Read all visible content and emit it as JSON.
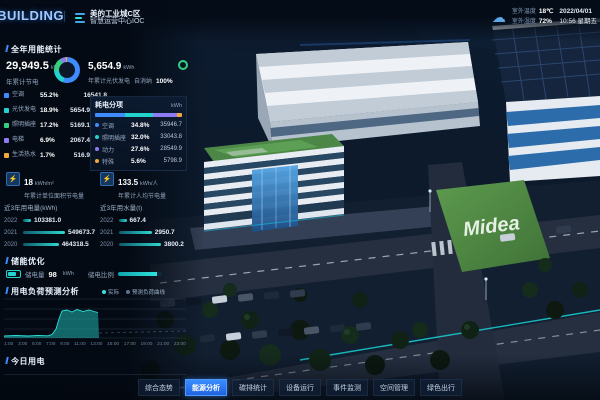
{
  "header": {
    "logo": "iBUILDING",
    "divider": "|",
    "brand_line1": "美的工业城C区",
    "brand_line2": "智慧运营中心IOC",
    "weather": {
      "cloud_icon": "☁",
      "temp_label": "室外温度",
      "temp_value": "18℃",
      "humidity_label": "室外湿度",
      "humidity_value": "72%",
      "date": "2022/04/01",
      "time": "10:56 星期五"
    }
  },
  "energy": {
    "section_title": "全年用能统计",
    "saving_value": "29,949.5",
    "saving_unit": "kWh",
    "saving_label": "年累计节电",
    "pv_value": "5,654.9",
    "pv_unit": "kWh",
    "pv_label": "年累计光伏发电",
    "pv_self_label": "自消纳",
    "pv_self_value": "100%",
    "breakdown": [
      {
        "label": "空调",
        "percent": "55.2%",
        "pct": 55.2,
        "value": "16541.8",
        "color": "#3f8cff"
      },
      {
        "label": "光伏发电",
        "percent": "18.9%",
        "pct": 18.9,
        "value": "5654.9",
        "color": "#22d3cd"
      },
      {
        "label": "照明插座",
        "percent": "17.2%",
        "pct": 17.2,
        "value": "5169.1",
        "color": "#35d07f"
      },
      {
        "label": "电梯",
        "percent": "6.9%",
        "pct": 6.9,
        "value": "2067.4",
        "color": "#8d7bf4"
      },
      {
        "label": "生活热水",
        "percent": "1.7%",
        "pct": 1.7,
        "value": "516.9",
        "color": "#f2a93b"
      }
    ]
  },
  "consumption": {
    "title": "耗电分项",
    "unit": "kWh",
    "rows": [
      {
        "label": "空调",
        "percent": "34.8%",
        "pct": 34.8,
        "value": "35946.7",
        "color": "#3f8cff"
      },
      {
        "label": "照明插座",
        "percent": "32.0%",
        "pct": 32.0,
        "value": "33043.8",
        "color": "#22d3cd"
      },
      {
        "label": "动力",
        "percent": "27.6%",
        "pct": 27.6,
        "value": "28549.9",
        "color": "#8d7bf4"
      },
      {
        "label": "特殊",
        "percent": "5.6%",
        "pct": 5.6,
        "value": "5798.9",
        "color": "#f2a93b"
      }
    ]
  },
  "kpis": [
    {
      "icon": "⚡",
      "value": "18",
      "unit": "kWh/m²",
      "label": "年累计单位面积节电量"
    },
    {
      "icon": "⚡",
      "value": "133.5",
      "unit": "kWh/人",
      "label": "年累计人均节电量"
    }
  ],
  "elec3yr": {
    "title": "近3年用电量(kWh)",
    "rows": [
      {
        "year": "2022",
        "value": "103381.0",
        "pct": 19
      },
      {
        "year": "2021",
        "value": "549673.7",
        "pct": 100
      },
      {
        "year": "2020",
        "value": "464318.5",
        "pct": 85
      }
    ]
  },
  "water3yr": {
    "title": "近3年用水量(t)",
    "rows": [
      {
        "year": "2022",
        "value": "667.4",
        "pct": 18
      },
      {
        "year": "2021",
        "value": "2950.7",
        "pct": 78
      },
      {
        "year": "2020",
        "value": "3800.2",
        "pct": 100
      }
    ]
  },
  "storage": {
    "title": "储能优化",
    "charge_label": "储电量",
    "charge_value": "98",
    "charge_unit": "kWh",
    "ratio_label": "储电比例",
    "ratio_pct": 90
  },
  "forecast": {
    "title": "用电负荷预测分析",
    "legend_actual": "实际",
    "legend_forecast": "预测负荷曲线",
    "x_labels": [
      "1:00",
      "3:00",
      "5:00",
      "7:00",
      "9:00",
      "11:00",
      "13:00",
      "15:00",
      "17:00",
      "19:00",
      "21:00",
      "23:00"
    ]
  },
  "today": {
    "title": "今日用电"
  },
  "nav": {
    "items": [
      {
        "label": "综合态势",
        "active": false
      },
      {
        "label": "能源分析",
        "active": true
      },
      {
        "label": "碳排统计",
        "active": false
      },
      {
        "label": "设备运行",
        "active": false
      },
      {
        "label": "事件监测",
        "active": false
      },
      {
        "label": "空间管理",
        "active": false
      },
      {
        "label": "绿色出行",
        "active": false
      }
    ]
  },
  "scene": {
    "midea_logo": "Midea"
  },
  "colors": {
    "accent_blue": "#3b8dff",
    "accent_teal": "#2fe3da",
    "pv_green": "#35d07f"
  }
}
